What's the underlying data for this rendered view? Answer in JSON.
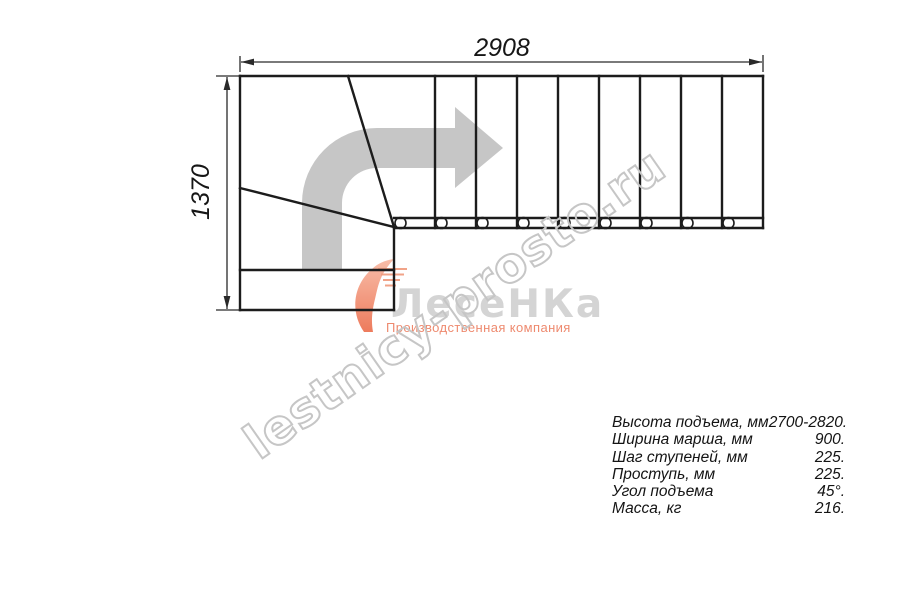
{
  "drawing": {
    "dimension_width": "2908",
    "dimension_height": "1370"
  },
  "watermark": {
    "text": "lestnicy-prosto.ru"
  },
  "logo": {
    "brand": "ЛесеНКа",
    "tagline": "Производственная компания"
  },
  "specs": {
    "rows": [
      {
        "label": "Высота подъема, мм",
        "value": "2700-2820."
      },
      {
        "label": "Ширина марша, мм",
        "value": "900."
      },
      {
        "label": "Шаг ступеней, мм",
        "value": "225."
      },
      {
        "label": "Проступь, мм",
        "value": "225."
      },
      {
        "label": "Угол подъема",
        "value": "45°."
      },
      {
        "label": "Масса, кг",
        "value": "216."
      }
    ]
  },
  "colors": {
    "line": "#1c1c1c",
    "arrow": "#c6c6c6",
    "watermark_outline": "#c6c6c6",
    "logo_gray": "#d4d4d4",
    "logo_accent": "#ee8a6f"
  }
}
